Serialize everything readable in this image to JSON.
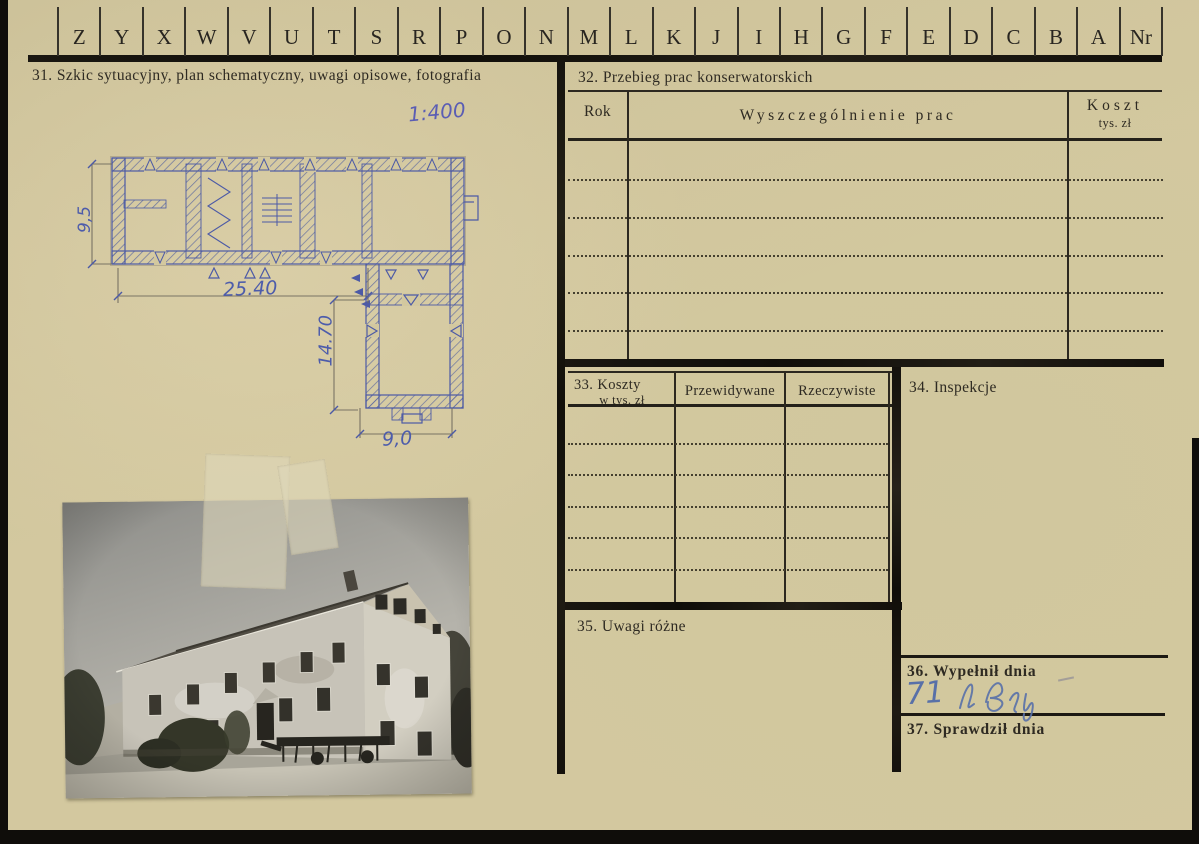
{
  "palette": {
    "card_bg": "#d3c89f",
    "ink_black": "#2c2820",
    "heavy_line": "#14110d",
    "blue_ink": "#4c5aa6",
    "handwriting_blue": "#5870a8"
  },
  "tabs": {
    "letters": [
      "Z",
      "Y",
      "X",
      "W",
      "V",
      "U",
      "T",
      "S",
      "R",
      "P",
      "O",
      "N",
      "M",
      "L",
      "K",
      "J",
      "I",
      "H",
      "G",
      "F",
      "E",
      "D",
      "C",
      "B",
      "A",
      "Nr"
    ]
  },
  "sections": {
    "s31": {
      "label": "31. Szkic sytuacyjny, plan schematyczny, uwagi opisowe, fotografia"
    },
    "s32": {
      "label": "32. Przebieg prac konserwatorskich",
      "col_rok": "Rok",
      "col_prace": "Wyszczególnienie prac",
      "col_koszt": "Koszt",
      "col_koszt_sub": "tys. zł"
    },
    "s33": {
      "label": "33. Koszty",
      "sublabel": "w tys. zł",
      "col_przewidywane": "Przewidywane",
      "col_rzeczywiste": "Rzeczywiste"
    },
    "s34": {
      "label": "34. Inspekcje"
    },
    "s35": {
      "label": "35. Uwagi różne"
    },
    "s36": {
      "label": "36. Wypełnił dnia",
      "handwritten": "71"
    },
    "s37": {
      "label": "37. Sprawdził dnia"
    }
  },
  "sketch": {
    "scale_note": "1:400",
    "dim_length": "25.40",
    "dim_depth": "14.70",
    "dim_wing": "9,0",
    "dim_left": "9,5"
  }
}
